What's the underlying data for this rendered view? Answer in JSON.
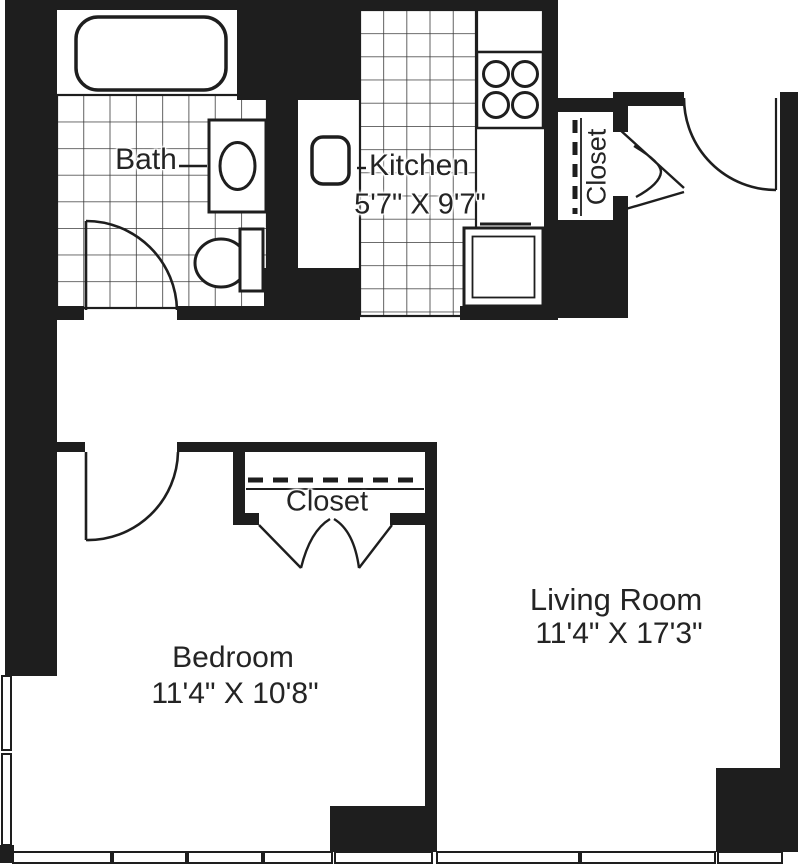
{
  "floorplan": {
    "rooms": {
      "bath": {
        "name": "Bath"
      },
      "kitchen": {
        "name": "Kitchen",
        "dims": "5'7\" X 9'7\""
      },
      "entry_closet": {
        "name": "Closet"
      },
      "bedroom_closet": {
        "name": "Closet"
      },
      "bedroom": {
        "name": "Bedroom",
        "dims": "11'4\" X 10'8\""
      },
      "living_room": {
        "name": "Living Room",
        "dims": "11'4\" X 17'3\""
      }
    },
    "fixtures": [
      "bathtub",
      "vanity-sink",
      "toilet",
      "kitchen-sink",
      "stove-4-burner",
      "counter-appliance"
    ],
    "doors": [
      "bath-door",
      "bedroom-door",
      "entry-door",
      "entry-closet-bifold",
      "bedroom-closet-bifold"
    ],
    "windows": [
      "bedroom-left-windows",
      "south-window-band"
    ],
    "colors": {
      "wall": "#1e1e1e",
      "line": "#242424",
      "tile_line": "#3a3a3a",
      "background": "#ffffff"
    }
  }
}
